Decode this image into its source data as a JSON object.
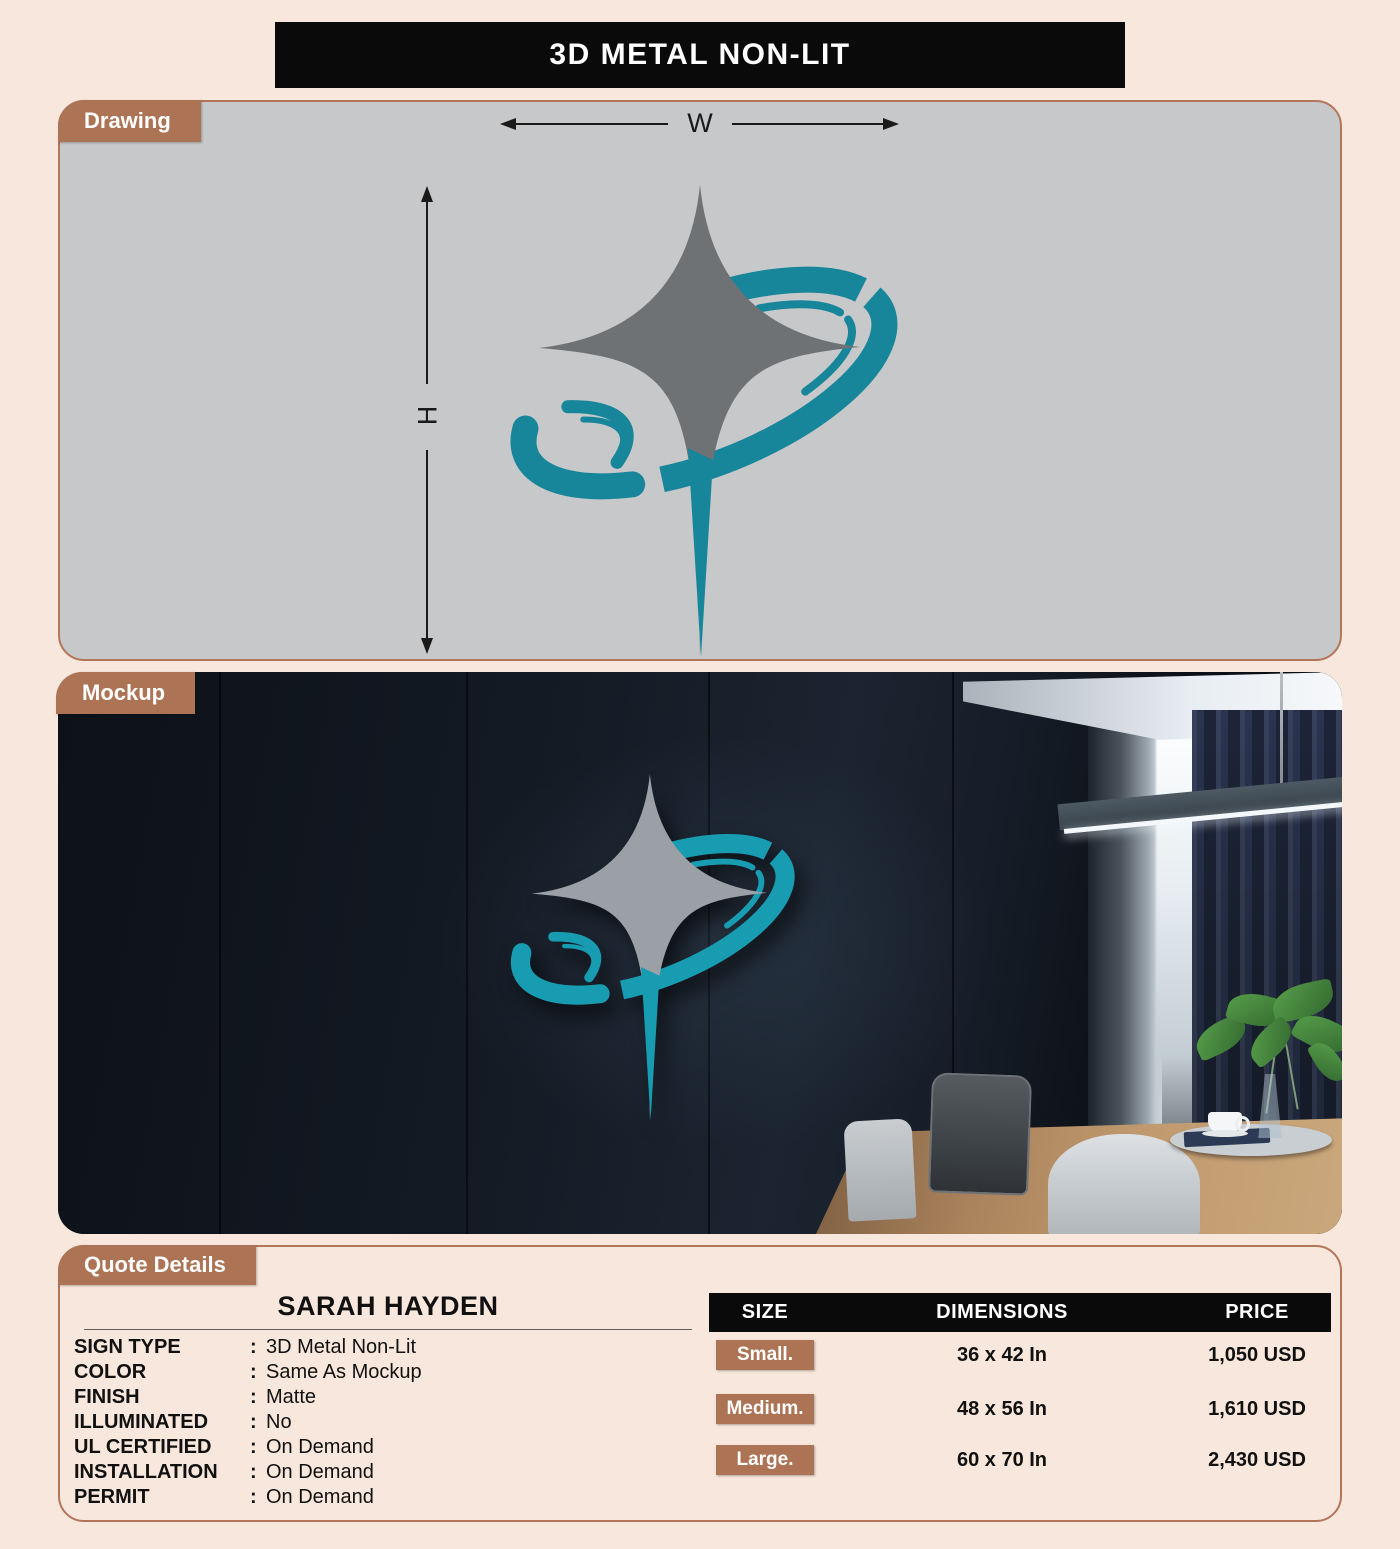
{
  "title": "3D METAL NON-LIT",
  "sections": {
    "drawing_label": "Drawing",
    "mockup_label": "Mockup",
    "quote_label": "Quote Details"
  },
  "drawing": {
    "width_label": "W",
    "height_label": "H"
  },
  "quote": {
    "customer_name": "SARAH HAYDEN",
    "separator": ":",
    "details": [
      {
        "label": "SIGN TYPE",
        "value": "3D Metal Non-Lit"
      },
      {
        "label": "COLOR",
        "value": "Same As Mockup"
      },
      {
        "label": "FINISH",
        "value": "Matte"
      },
      {
        "label": "ILLUMINATED",
        "value": "No"
      },
      {
        "label": "UL CERTIFIED",
        "value": "On Demand"
      },
      {
        "label": "INSTALLATION",
        "value": "On Demand"
      },
      {
        "label": "PERMIT",
        "value": "On Demand"
      }
    ],
    "pricing": {
      "headers": [
        "SIZE",
        "DIMENSIONS",
        "PRICE"
      ],
      "rows": [
        {
          "size": "Small.",
          "dimensions": "36 x 42 In",
          "price": "1,050 USD"
        },
        {
          "size": "Medium.",
          "dimensions": "48 x 56 In",
          "price": "1,610 USD"
        },
        {
          "size": "Large.",
          "dimensions": "60 x 70 In",
          "price": "2,430 USD"
        }
      ]
    }
  },
  "colors": {
    "background": "#f8e7dc",
    "accent_brown": "#ad7355",
    "banner_black": "#0a0a0a",
    "drawing_panel_gray": "#c6c8ca",
    "logo_star_gray": "#6f7275",
    "logo_swoosh_teal": "#17869a",
    "mockup_wall_navy": "#141b25"
  }
}
